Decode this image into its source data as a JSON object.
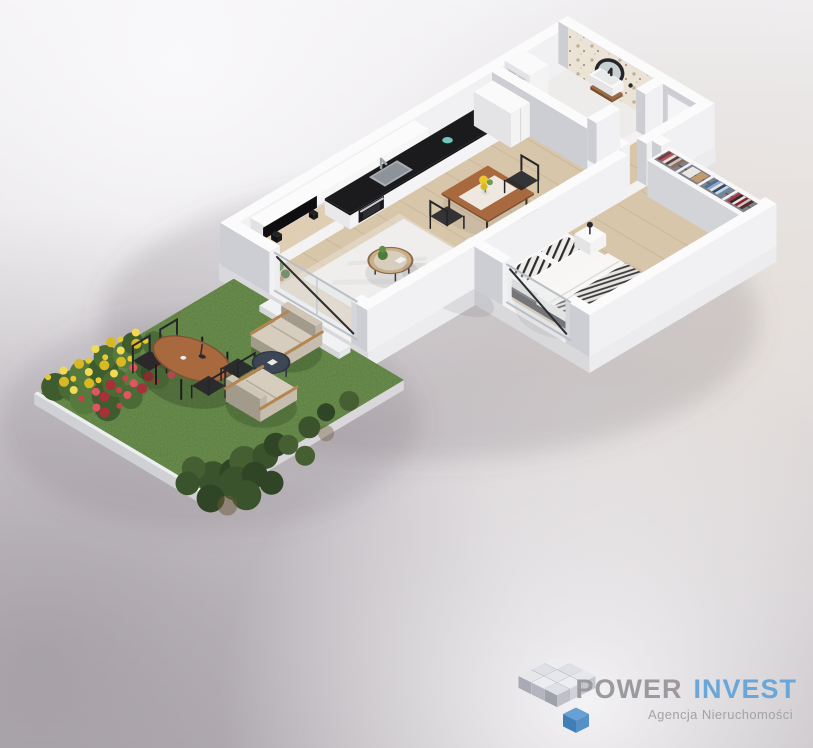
{
  "logo": {
    "icon": "isometric-cubes-logo",
    "brand_primary": "POWER",
    "brand_secondary": "INVEST",
    "tagline": "Agencja Nieruchomości"
  },
  "colors": {
    "background_top": "#f1f0f3",
    "background_mid": "#d8d4d8",
    "background_bottom": "#bcb7bc",
    "wall_top": "#fbfbfc",
    "wall_shade": "#cdced3",
    "wall_light": "#f1f1f3",
    "slab_top": "#f2f2f3",
    "slab_shade": "#d9d9dc",
    "slab_light": "#ececee",
    "wood_floor": "#d8c6ab",
    "plank_line": "#c0a98b",
    "bathroom_floor": "#edecea",
    "tile_base": "#ebe3d6",
    "tile_dot": "#c3b093",
    "countertop": "#1b1b1e",
    "steel": "#a9aeb4",
    "appliance_black": "#1a1a1d",
    "teal_accent": "#6fc7c2",
    "furniture_wood": "#a9693f",
    "furniture_wood_dark": "#7f5233",
    "rug": "#efeeec",
    "sofa": "#d8d5d0",
    "sofa_shade": "#b9b5ae",
    "bed_frame": "#46464b",
    "linen_white": "#f7f6f4",
    "pillow_pattern": "#2b2b2e",
    "grass": "#628547",
    "grass_dark": "#3f5c2d",
    "foliage": "#45662f",
    "bush": "#35502a",
    "flower_yellow": "#e8c930",
    "flower_red": "#cc4049",
    "lounge_beige": "#d6cdbe",
    "lounge_shade": "#a29a8b",
    "armrest_wood": "#b5854f",
    "side_table_navy": "#3d4654",
    "glass_tint": "#dfe6ea",
    "door_frame_dark": "#2e2e31",
    "logo_gray": "#9b9a9e",
    "logo_blue": "#6ba6d9",
    "tagline_gray": "#a3a2a6",
    "logo_cube_light": "#e6e7eb",
    "logo_cube_mid": "#c6c8cf",
    "logo_cube_dark": "#a9abb4",
    "logo_cube_blue_top": "#66a0d4",
    "logo_cube_blue_left": "#3f7fb5",
    "logo_cube_blue_right": "#5590c6"
  },
  "wardrobe_sections": {
    "hanging_a": [
      "#7c3a3f",
      "#a65a5a",
      "#e8e4df",
      "#5a3e3e",
      "#c7c2bc",
      "#8e6a5a"
    ],
    "folded": [
      "#eae7e2",
      "#c49a6c"
    ],
    "hanging_b": [
      "#4a6f9e",
      "#8fa8c6",
      "#e6e4e0",
      "#2e4a70",
      "#cdd5de",
      "#6b88aa"
    ],
    "hanging_c": [
      "#b03040",
      "#2b2b2e",
      "#e8e5e0",
      "#8a1f2d",
      "#c9c5c0",
      "#54282c"
    ]
  }
}
